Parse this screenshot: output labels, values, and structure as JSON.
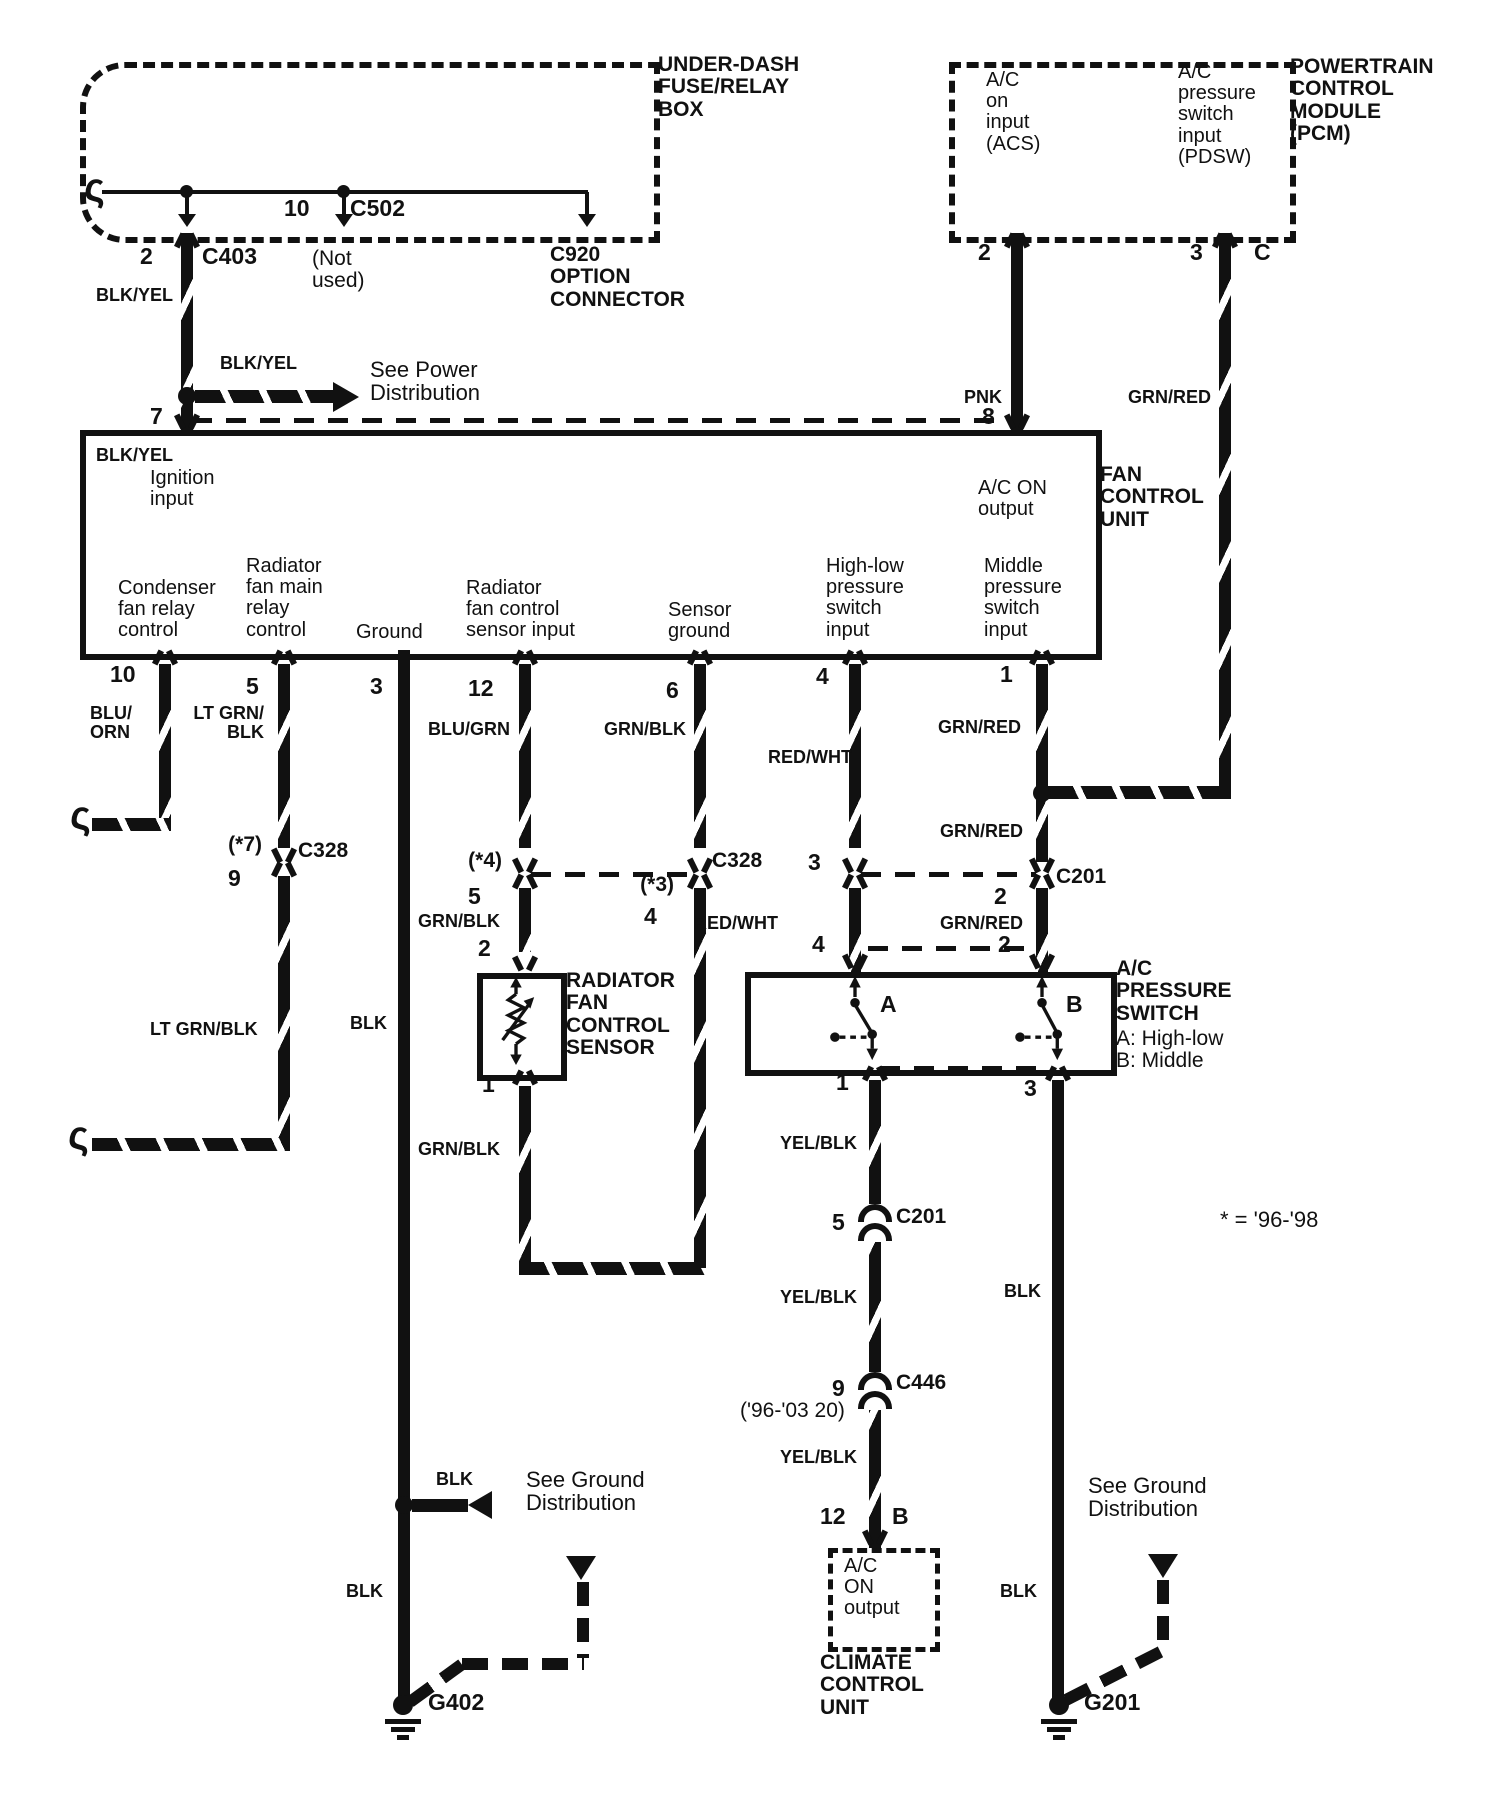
{
  "colors": {
    "ink": "#111111",
    "bg": "#ffffff"
  },
  "note": "* = '96-'98",
  "fuse_box": {
    "title": "UNDER-DASH\nFUSE/RELAY\nBOX",
    "pin_10": "10",
    "c502": "C502",
    "pin_2": "2",
    "c403": "C403",
    "not_used": "(Not\nused)",
    "c920": "C920\nOPTION\nCONNECTOR"
  },
  "power": {
    "label_top": "BLK/YEL",
    "arrow_label": "BLK/YEL",
    "see": "See Power\nDistribution",
    "label_bottom": "BLK/YEL",
    "pin_7": "7"
  },
  "pcm": {
    "title": "POWERTRAIN\nCONTROL\nMODULE\n(PCM)",
    "acs": "A/C\non\ninput\n(ACS)",
    "pdsw": "A/C\npressure\nswitch\ninput\n(PDSW)",
    "pin_2": "2",
    "pin_3": "3",
    "pin_c": "C",
    "pnk": "PNK",
    "grn_red": "GRN/RED",
    "pin_8": "8"
  },
  "fcu": {
    "title": "FAN\nCONTROL\nUNIT",
    "ignition": "Ignition\ninput",
    "ac_on": "A/C ON\noutput",
    "condenser": "Condenser\nfan relay\ncontrol",
    "rad_main": "Radiator\nfan main\nrelay\ncontrol",
    "ground": "Ground",
    "rad_sensor": "Radiator\nfan control\nsensor input",
    "sensor_ground": "Sensor\nground",
    "high_low": "High-low\npressure\nswitch\ninput",
    "middle": "Middle\npressure\nswitch\ninput",
    "pin_10": "10",
    "pin_5": "5",
    "pin_3": "3",
    "pin_12": "12",
    "pin_6": "6",
    "pin_4": "4",
    "pin_1": "1"
  },
  "wires": {
    "blu_orn": "BLU/\nORN",
    "lt_grn_blk_upper": "LT GRN/\nBLK",
    "lt_grn_blk_lower": "LT GRN/BLK",
    "blk_mid": "BLK",
    "blu_grn": "BLU/GRN",
    "grn_blk_col6": "GRN/BLK",
    "grn_blk_sensor_top": "GRN/BLK",
    "grn_blk_sensor_bottom": "GRN/BLK",
    "red_wht_upper": "RED/WHT",
    "red_wht_lower": "RED/WHT",
    "grn_red_1": "GRN/RED",
    "grn_red_2": "GRN/RED",
    "grn_red_3": "GRN/RED",
    "yel_blk_1": "YEL/BLK",
    "yel_blk_2": "YEL/BLK",
    "yel_blk_3": "YEL/BLK",
    "blk_right_upper": "BLK",
    "blk_right_lower": "BLK",
    "blk_arrow": "BLK",
    "blk_lower": "BLK"
  },
  "c328_left": {
    "star": "(*7)",
    "pin": "9",
    "label": "C328"
  },
  "c328_right": {
    "star_left": "(*4)",
    "pin_left": "5",
    "star_right": "(*3)",
    "pin_right": "4",
    "label": "C328"
  },
  "c201_top": {
    "pin_left": "3",
    "pin_right": "2",
    "label": "C201"
  },
  "sensor": {
    "pin_top": "2",
    "pin_bottom": "1",
    "title": "RADIATOR\nFAN\nCONTROL\nSENSOR"
  },
  "ac_switch": {
    "pin_top_left": "4",
    "pin_top_right": "2",
    "a": "A",
    "b": "B",
    "title": "A/C\nPRESSURE\nSWITCH",
    "a_desc": "A: High-low",
    "b_desc": "B: Middle",
    "pin_bottom_left": "1",
    "pin_bottom_right": "3"
  },
  "c201_bottom": {
    "pin": "5",
    "label": "C201"
  },
  "c446": {
    "pin": "9",
    "label": "C446",
    "alt": "('96-'03 20)"
  },
  "climate": {
    "pin_12": "12",
    "pin_b": "B",
    "output": "A/C\nON\noutput",
    "title": "CLIMATE\nCONTROL\nUNIT"
  },
  "grounds": {
    "see_left": "See Ground\nDistribution",
    "see_right": "See Ground\nDistribution",
    "g402": "G402",
    "g201": "G201"
  }
}
